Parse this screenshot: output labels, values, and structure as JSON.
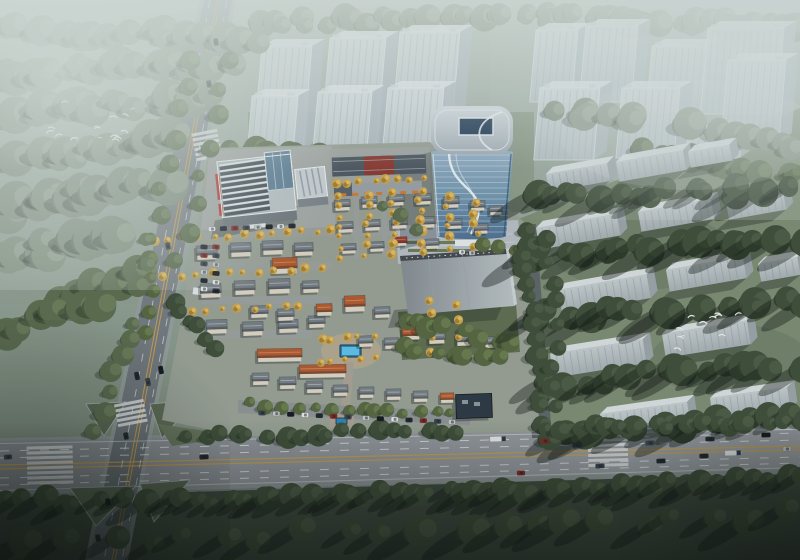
{
  "canvas": {
    "width": 800,
    "height": 560
  },
  "palette": {
    "sky_top": "#aeb9b2",
    "sky_mid": "#93a297",
    "sky_bottom": "#707f6d",
    "fog": "#d6e0dc",
    "road_a_top": "#878e94",
    "road_a_bottom": "#646b71",
    "road_b_left": "#8a8e95",
    "road_b_right": "#9ba0a5",
    "road_c": "#5c6367",
    "lane_white": "#e6e9ea",
    "lane_yellow": "#c9a14e",
    "island_green": "#5a6852",
    "right_lawn": "#7c8b72",
    "bottom_lawn": "#3c493d",
    "site_ground": "#98a095",
    "site_paving": "#a3a8a5",
    "site_street": "#9aa09c",
    "plaza": "#b6bdc3",
    "park_lawn": "#5e6d50",
    "pool_deck": "#b2a792",
    "pool_water": "#5ec1e8",
    "pool_water_deep": "#2b84b4",
    "glass_top": "#97b1c6",
    "glass_bottom": "#4e7093",
    "tower_roof_light": "#d3dce1",
    "tower_roof_dark": "#a2aeb7",
    "skylight": "#1f3a55",
    "ghost_face_top": "#d8e0e3",
    "ghost_face_bottom": "#b9c4ca",
    "ghost_top": "#e3e9ec",
    "ghost_side": "#afbac2",
    "slab_top": "#dde3e5",
    "slab_side": "#99a3a8",
    "roof_gray": "#757d84",
    "roof_orange": "#b05a2f",
    "roof_red": "#9a392e",
    "roof_navy": "#2b3642",
    "wall_cream": "#dcd5c5",
    "office_glass": "#39444d",
    "office_rib": "#e7ebed",
    "office_red": "#b23a30",
    "townhouse_roof": "#4e5862",
    "townhouse_red": "#8a3a32",
    "awning_orange": "#cf7a33",
    "shadow": "rgba(20,28,24,0.32)",
    "cars": [
      "#e9ebed",
      "#20262e",
      "#8c2420",
      "#39424d",
      "#c6cacd",
      "#11161c"
    ],
    "tree": {
      "mist": [
        "#82907f",
        "#6a7868",
        "#93a08f"
      ],
      "mid": [
        "#5a6b4d",
        "#49583e",
        "#6b7c5a"
      ],
      "dark": [
        "#3d4d37",
        "#2f3d2b",
        "#4a5a42"
      ],
      "site": [
        "#55663f",
        "#43522f",
        "#687a4c"
      ],
      "gold": [
        "#caa44d",
        "#a8812f",
        "#e0bd62"
      ]
    }
  },
  "scene": {
    "legend": {
      "ghost_towers": "[x, y, width, height] translucent context high-rise",
      "slabs": "[x, y, width, height, rotationDeg] translucent residential slab",
      "villas": "[x, y, width, height, roofType g|o|r, rotationDeg]",
      "tree_bands": "[layer, tone, x1, y1, x2, y2, count, radius, shadowType]",
      "parked_rows": "[x1, y1, x2, y2, count, carRotationDeg]",
      "vehicles": "[x, y, length, rotationDeg, colorIndex]",
      "birds": "[x1, y1, x2, y2, count] flock bounding box",
      "crosswalks": "[cx, cy, rotationDeg, barCount, barLength]"
    },
    "ghost_towers_left": [
      [
        262,
        46,
        50,
        104
      ],
      [
        330,
        38,
        56,
        110
      ],
      [
        400,
        32,
        60,
        112
      ],
      [
        252,
        96,
        46,
        80
      ],
      [
        318,
        92,
        54,
        82
      ],
      [
        388,
        88,
        56,
        78
      ]
    ],
    "ghost_towers_right": [
      [
        536,
        30,
        42,
        72
      ],
      [
        586,
        26,
        52,
        76
      ],
      [
        652,
        46,
        56,
        66
      ],
      [
        708,
        28,
        76,
        86
      ],
      [
        540,
        88,
        60,
        72
      ],
      [
        622,
        88,
        58,
        70
      ],
      [
        728,
        60,
        58,
        82
      ],
      [
        688,
        132,
        54,
        26
      ]
    ],
    "slabs": [
      [
        546,
        174,
        62,
        18,
        -10
      ],
      [
        616,
        162,
        68,
        20,
        -10
      ],
      [
        688,
        152,
        42,
        16,
        -10
      ],
      [
        536,
        228,
        82,
        22,
        -10
      ],
      [
        638,
        212,
        74,
        20,
        -10
      ],
      [
        726,
        202,
        58,
        18,
        -10
      ],
      [
        558,
        290,
        90,
        24,
        -10
      ],
      [
        666,
        270,
        78,
        22,
        -10
      ],
      [
        758,
        264,
        40,
        18,
        -10
      ],
      [
        550,
        354,
        94,
        24,
        -9
      ],
      [
        662,
        334,
        86,
        24,
        -9
      ],
      [
        600,
        414,
        88,
        22,
        -8
      ],
      [
        710,
        398,
        78,
        22,
        -8
      ]
    ],
    "villas": [
      [
        334,
        200,
        16,
        11,
        "g",
        -3
      ],
      [
        361,
        197,
        16,
        11,
        "g",
        -3
      ],
      [
        388,
        195,
        16,
        11,
        "g",
        -3
      ],
      [
        415,
        194,
        16,
        11,
        "g",
        -3
      ],
      [
        443,
        197,
        16,
        11,
        "g",
        -2
      ],
      [
        470,
        201,
        15,
        10,
        "g",
        -2
      ],
      [
        337,
        222,
        16,
        11,
        "g",
        -3
      ],
      [
        364,
        220,
        16,
        11,
        "g",
        -3
      ],
      [
        391,
        218,
        16,
        11,
        "g",
        -3
      ],
      [
        419,
        217,
        16,
        11,
        "g",
        -2
      ],
      [
        447,
        219,
        15,
        10,
        "g",
        -2
      ],
      [
        474,
        224,
        14,
        10,
        "g",
        -2
      ],
      [
        341,
        244,
        15,
        10,
        "g",
        -3
      ],
      [
        369,
        242,
        15,
        10,
        "g",
        -3
      ],
      [
        425,
        239,
        14,
        10,
        "g",
        -2
      ],
      [
        489,
        206,
        13,
        9,
        "g",
        -2
      ],
      [
        395,
        237,
        12,
        9,
        "r",
        -2
      ],
      [
        196,
        246,
        21,
        14,
        "g",
        -2
      ],
      [
        230,
        243,
        21,
        14,
        "g",
        -2
      ],
      [
        262,
        241,
        21,
        14,
        "g",
        -2
      ],
      [
        294,
        243,
        19,
        13,
        "g",
        -2
      ],
      [
        200,
        284,
        21,
        14,
        "g",
        -2
      ],
      [
        234,
        281,
        21,
        14,
        "g",
        -2
      ],
      [
        268,
        279,
        22,
        15,
        "g",
        -2
      ],
      [
        302,
        281,
        17,
        12,
        "g",
        -2
      ],
      [
        206,
        320,
        21,
        14,
        "g",
        -2
      ],
      [
        242,
        322,
        21,
        14,
        "g",
        -2
      ],
      [
        278,
        320,
        20,
        13,
        "g",
        -2
      ],
      [
        308,
        316,
        17,
        12,
        "g",
        -2
      ],
      [
        272,
        258,
        25,
        16,
        "o",
        -2
      ],
      [
        250,
        306,
        18,
        12,
        "g",
        -2
      ],
      [
        277,
        309,
        17,
        12,
        "g",
        -2
      ],
      [
        316,
        304,
        16,
        12,
        "o",
        -2
      ],
      [
        344,
        296,
        21,
        16,
        "o",
        -2
      ],
      [
        374,
        307,
        16,
        11,
        "g",
        -2
      ],
      [
        257,
        349,
        45,
        13,
        "o",
        -1
      ],
      [
        299,
        365,
        47,
        13,
        "o",
        -1
      ],
      [
        402,
        328,
        18,
        12,
        "o",
        -2
      ],
      [
        428,
        332,
        17,
        12,
        "g",
        -2
      ],
      [
        456,
        334,
        17,
        12,
        "g",
        -2
      ],
      [
        484,
        337,
        15,
        11,
        "g",
        -2
      ],
      [
        358,
        336,
        15,
        11,
        "g",
        -2
      ],
      [
        384,
        338,
        15,
        11,
        "g",
        -2
      ],
      [
        252,
        373,
        17,
        12,
        "g",
        -1
      ],
      [
        279,
        377,
        17,
        12,
        "g",
        -1
      ],
      [
        306,
        381,
        17,
        12,
        "g",
        -1
      ],
      [
        333,
        385,
        15,
        11,
        "g",
        -1
      ],
      [
        359,
        387,
        15,
        11,
        "g",
        -1
      ],
      [
        386,
        389,
        15,
        11,
        "g",
        -1
      ],
      [
        413,
        391,
        15,
        11,
        "g",
        -1
      ],
      [
        440,
        393,
        14,
        10,
        "o",
        -1
      ]
    ],
    "tree_bands": [
      [
        "bk",
        "mist",
        252,
        24,
        532,
        14,
        24,
        11,
        0
      ],
      [
        "bk",
        "mist",
        540,
        16,
        798,
        26,
        22,
        12,
        0
      ],
      [
        "tl",
        "mist",
        0,
        30,
        252,
        38,
        22,
        13,
        1
      ],
      [
        "tl",
        "mist",
        0,
        74,
        236,
        62,
        20,
        14,
        1
      ],
      [
        "tl",
        "mist",
        0,
        118,
        212,
        96,
        18,
        15,
        1
      ],
      [
        "tl",
        "mist",
        14,
        162,
        186,
        138,
        15,
        15,
        1
      ],
      [
        "tl",
        "mist",
        0,
        208,
        156,
        182,
        13,
        16,
        1
      ],
      [
        "tl",
        "mist",
        0,
        256,
        124,
        232,
        11,
        16,
        1
      ],
      [
        "tl",
        "mid",
        60,
        300,
        148,
        268,
        9,
        14,
        1
      ],
      [
        "tl",
        "mid",
        0,
        330,
        90,
        300,
        7,
        14,
        1
      ],
      [
        "md",
        "mid",
        258,
        150,
        420,
        166,
        12,
        11,
        1
      ],
      [
        "md",
        "mid",
        300,
        176,
        430,
        184,
        10,
        9,
        1
      ],
      [
        "md",
        "mist",
        560,
        108,
        640,
        120,
        6,
        12,
        1
      ],
      [
        "md",
        "mist",
        700,
        120,
        798,
        150,
        8,
        13,
        1
      ],
      [
        "md",
        "mid",
        640,
        150,
        798,
        176,
        10,
        12,
        1
      ],
      [
        "md",
        "mid",
        232,
        150,
        232,
        214,
        5,
        9,
        1
      ],
      [
        "fr",
        "dark",
        530,
        198,
        798,
        188,
        16,
        12,
        2
      ],
      [
        "fr",
        "dark",
        528,
        252,
        798,
        242,
        16,
        13,
        2
      ],
      [
        "fr",
        "dark",
        536,
        316,
        798,
        302,
        16,
        13,
        2
      ],
      [
        "fr",
        "dark",
        544,
        382,
        798,
        366,
        15,
        13,
        2
      ],
      [
        "fr",
        "dark",
        558,
        432,
        798,
        418,
        13,
        12,
        2
      ],
      [
        "fr",
        "dark",
        520,
        232,
        548,
        436,
        16,
        9,
        1
      ],
      [
        "fr",
        "dark",
        546,
        238,
        560,
        430,
        10,
        8,
        1
      ],
      [
        "rd",
        "dark",
        186,
        438,
        458,
        430,
        18,
        9,
        1
      ],
      [
        "rd",
        "dark",
        544,
        430,
        798,
        421,
        17,
        9,
        1
      ],
      [
        "rd",
        "dark",
        0,
        502,
        190,
        496,
        11,
        11,
        2
      ],
      [
        "rd",
        "dark",
        180,
        500,
        462,
        492,
        19,
        10,
        2
      ],
      [
        "rd",
        "dark",
        470,
        492,
        798,
        480,
        22,
        10,
        2
      ],
      [
        "rd",
        "dark",
        30,
        542,
        420,
        530,
        11,
        13,
        2
      ],
      [
        "rd",
        "dark",
        470,
        528,
        780,
        514,
        10,
        13,
        2
      ],
      [
        "rd",
        "mid",
        190,
        60,
        138,
        290,
        10,
        9,
        1
      ],
      [
        "rd",
        "mid",
        232,
        60,
        180,
        260,
        8,
        8,
        1
      ],
      [
        "rd",
        "mid",
        128,
        320,
        100,
        430,
        7,
        9,
        1
      ],
      [
        "rd",
        "site",
        254,
        404,
        452,
        414,
        14,
        6,
        1
      ],
      [
        "st",
        "site",
        406,
        318,
        512,
        342,
        9,
        9,
        1
      ],
      [
        "st",
        "site",
        402,
        346,
        500,
        360,
        7,
        8,
        1
      ],
      [
        "st",
        "dark",
        178,
        302,
        212,
        346,
        6,
        8,
        1
      ],
      [
        "st",
        "site",
        152,
        238,
        150,
        330,
        6,
        7,
        1
      ],
      [
        "st",
        "site",
        480,
        246,
        512,
        252,
        3,
        6,
        0
      ],
      [
        "st",
        "mid",
        388,
        206,
        420,
        228,
        3,
        7,
        0
      ],
      [
        "gd",
        "gold",
        340,
        196,
        340,
        258,
        7,
        4,
        0
      ],
      [
        "gd",
        "gold",
        367,
        194,
        367,
        256,
        7,
        4,
        0
      ],
      [
        "gd",
        "gold",
        394,
        192,
        394,
        254,
        7,
        4,
        0
      ],
      [
        "gd",
        "gold",
        421,
        191,
        421,
        252,
        7,
        4,
        0
      ],
      [
        "gd",
        "gold",
        449,
        195,
        449,
        248,
        6,
        4,
        0
      ],
      [
        "gd",
        "gold",
        476,
        202,
        476,
        246,
        5,
        4,
        0
      ],
      [
        "gd",
        "gold",
        336,
        184,
        424,
        178,
        8,
        4,
        0
      ],
      [
        "gd",
        "gold",
        156,
        240,
        330,
        230,
        13,
        4,
        0
      ],
      [
        "gd",
        "gold",
        165,
        276,
        320,
        268,
        11,
        4,
        0
      ],
      [
        "gd",
        "gold",
        174,
        312,
        300,
        306,
        9,
        4,
        0
      ],
      [
        "gd",
        "gold",
        320,
        340,
        372,
        336,
        5,
        4,
        0
      ],
      [
        "gd",
        "gold",
        318,
        362,
        374,
        358,
        5,
        4,
        0
      ],
      [
        "gd",
        "gold",
        430,
        300,
        430,
        352,
        5,
        4,
        0
      ],
      [
        "gd",
        "gold",
        458,
        306,
        458,
        350,
        4,
        4,
        0
      ]
    ],
    "parked_rows": [
      [
        212,
        229,
        292,
        226,
        8,
        -3
      ],
      [
        204,
        247,
        204,
        289,
        6,
        4
      ],
      [
        216,
        247,
        216,
        291,
        6,
        4
      ],
      [
        262,
        413,
        348,
        417,
        7,
        1
      ],
      [
        366,
        418,
        452,
        422,
        7,
        1
      ]
    ],
    "vehicles": [
      [
        498,
        439,
        17,
        -2,
        0
      ],
      [
        545,
        441,
        9,
        -2,
        2
      ],
      [
        577,
        445,
        9,
        -2,
        1
      ],
      [
        650,
        443,
        9,
        -2,
        3
      ],
      [
        710,
        439,
        9,
        -2,
        1
      ],
      [
        766,
        435,
        9,
        -2,
        5
      ],
      [
        733,
        453,
        17,
        -2,
        0
      ],
      [
        704,
        456,
        9,
        -2,
        1
      ],
      [
        521,
        473,
        8,
        -2,
        2
      ],
      [
        600,
        466,
        9,
        -2,
        3
      ],
      [
        661,
        461,
        9,
        -2,
        1
      ],
      [
        787,
        449,
        8,
        -2,
        4
      ],
      [
        204,
        457,
        9,
        -3,
        1
      ],
      [
        8,
        457,
        8,
        -3,
        3
      ],
      [
        137,
        376,
        8,
        79,
        1
      ],
      [
        148,
        382,
        8,
        79,
        3
      ],
      [
        161,
        370,
        8,
        79,
        5
      ],
      [
        216,
        42,
        7,
        79,
        1
      ],
      [
        209,
        84,
        7,
        79,
        3
      ],
      [
        168,
        246,
        7,
        79,
        3
      ],
      [
        126,
        436,
        7,
        79,
        1
      ],
      [
        108,
        502,
        7,
        79,
        5
      ],
      [
        98,
        538,
        7,
        79,
        1
      ],
      [
        462,
        252,
        6,
        -2,
        0
      ],
      [
        472,
        253,
        6,
        -2,
        4
      ]
    ],
    "birds": [
      [
        46,
        90,
        142,
        140,
        16
      ],
      [
        676,
        312,
        770,
        350,
        11
      ]
    ],
    "crosswalks": [
      [
        50,
        466,
        -1.5,
        8,
        46
      ],
      [
        608,
        451,
        -1.5,
        7,
        40
      ],
      [
        207,
        146,
        -11,
        6,
        26
      ],
      [
        131,
        414,
        -11,
        5,
        30
      ]
    ]
  }
}
